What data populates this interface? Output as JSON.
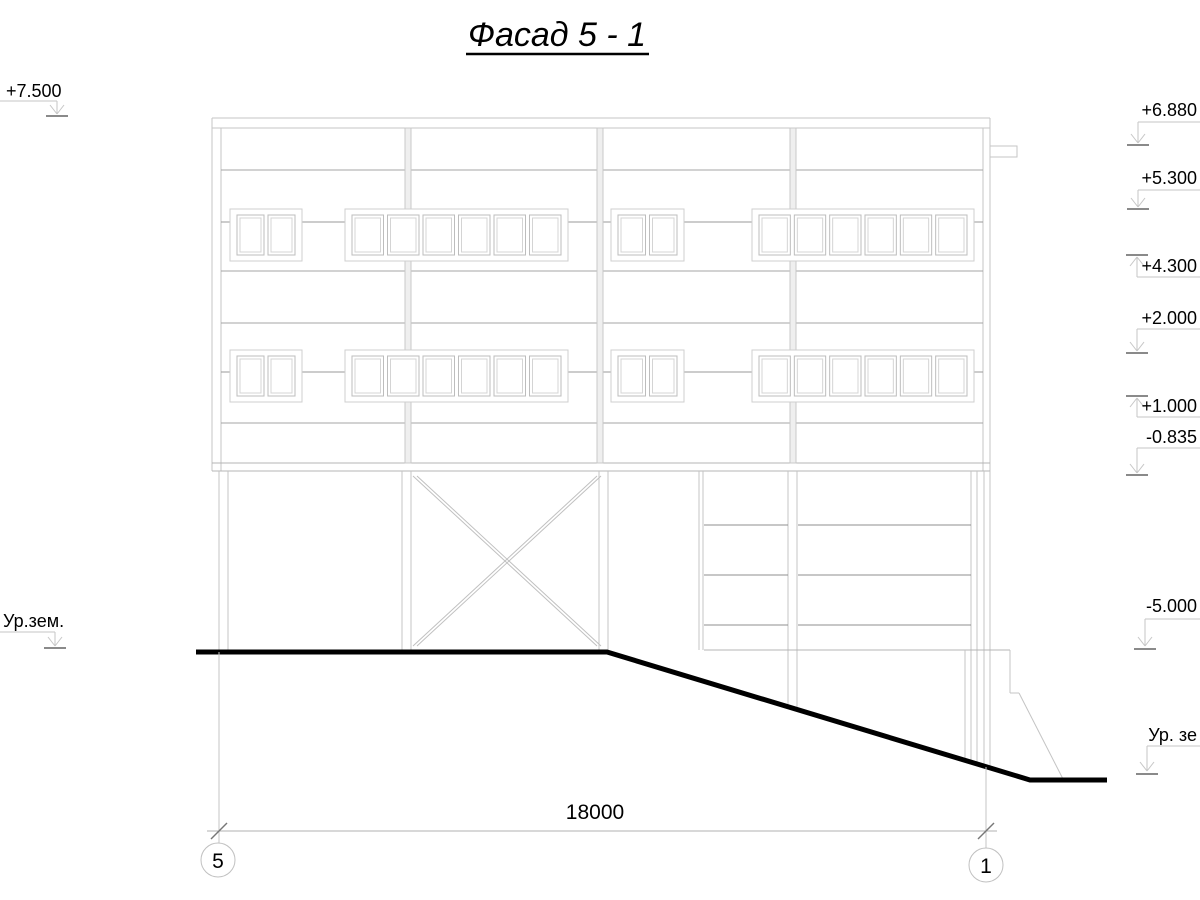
{
  "title": "Фасад 5 - 1",
  "marks_left": [
    {
      "label": "+7.500"
    },
    {
      "label": "Ур.зем."
    }
  ],
  "marks_right": [
    {
      "label": "+6.880"
    },
    {
      "label": "+5.300"
    },
    {
      "label": "+4.300"
    },
    {
      "label": "+2.000"
    },
    {
      "label": "+1.000"
    },
    {
      "label": "-0.835"
    },
    {
      "label": "-5.000"
    },
    {
      "label": "Ур. зе"
    }
  ],
  "dimension": {
    "length": "18000",
    "axis_start": "5",
    "axis_end": "1"
  },
  "colors": {
    "line_light": "#c6c6c6",
    "line_band": "#a4a4a4",
    "line_stair": "#8f8f8f",
    "line_tick": "#8a8a8a",
    "ground": "#000000",
    "text": "#000000"
  }
}
